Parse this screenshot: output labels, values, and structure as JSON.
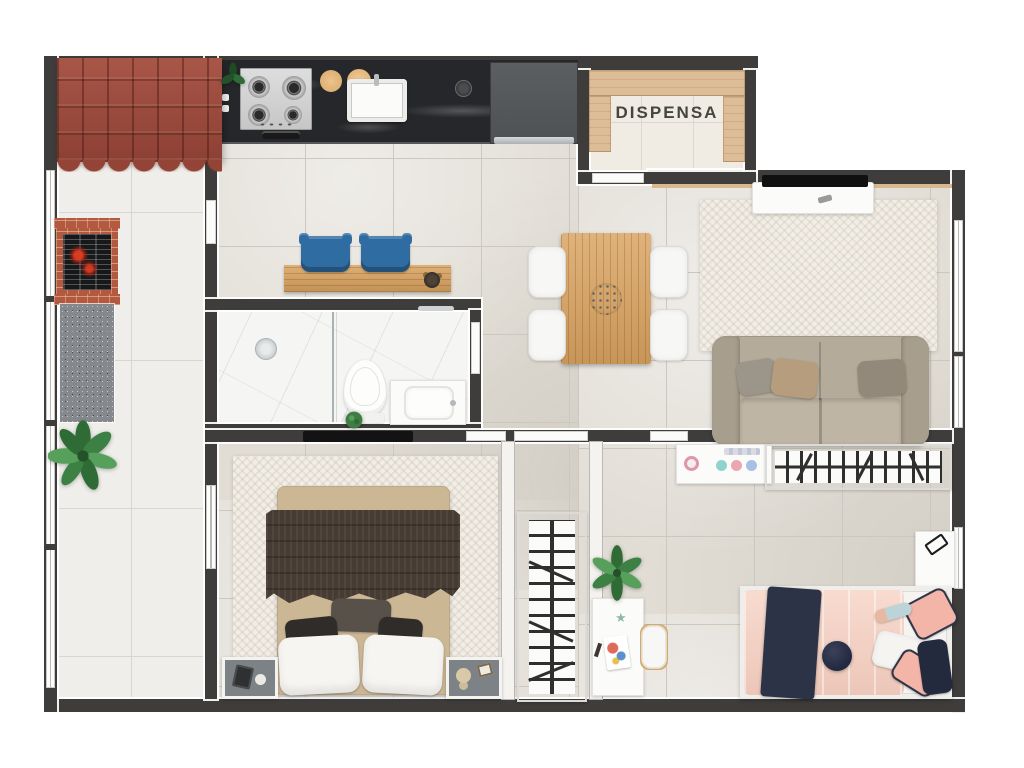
{
  "labels": {
    "pantry": "DISPENSA"
  },
  "palette": {
    "wall": "#3f3d3b",
    "floor": "#e1ddd5",
    "outdoor": "#efeeea",
    "bath": "#f5f5f4",
    "roof": "#9d4e40",
    "counter": "#25272a",
    "wood": "#d9a25f",
    "stool": "#2f6ca2",
    "sofa": "#b5ab9b",
    "rug": "#f2eee6",
    "blanket": "#473c34",
    "pink": "#f6cfc0",
    "navy": "#2d3347",
    "green": "#3c7a42",
    "granite": "#85888d",
    "brick": "#b2593f"
  }
}
